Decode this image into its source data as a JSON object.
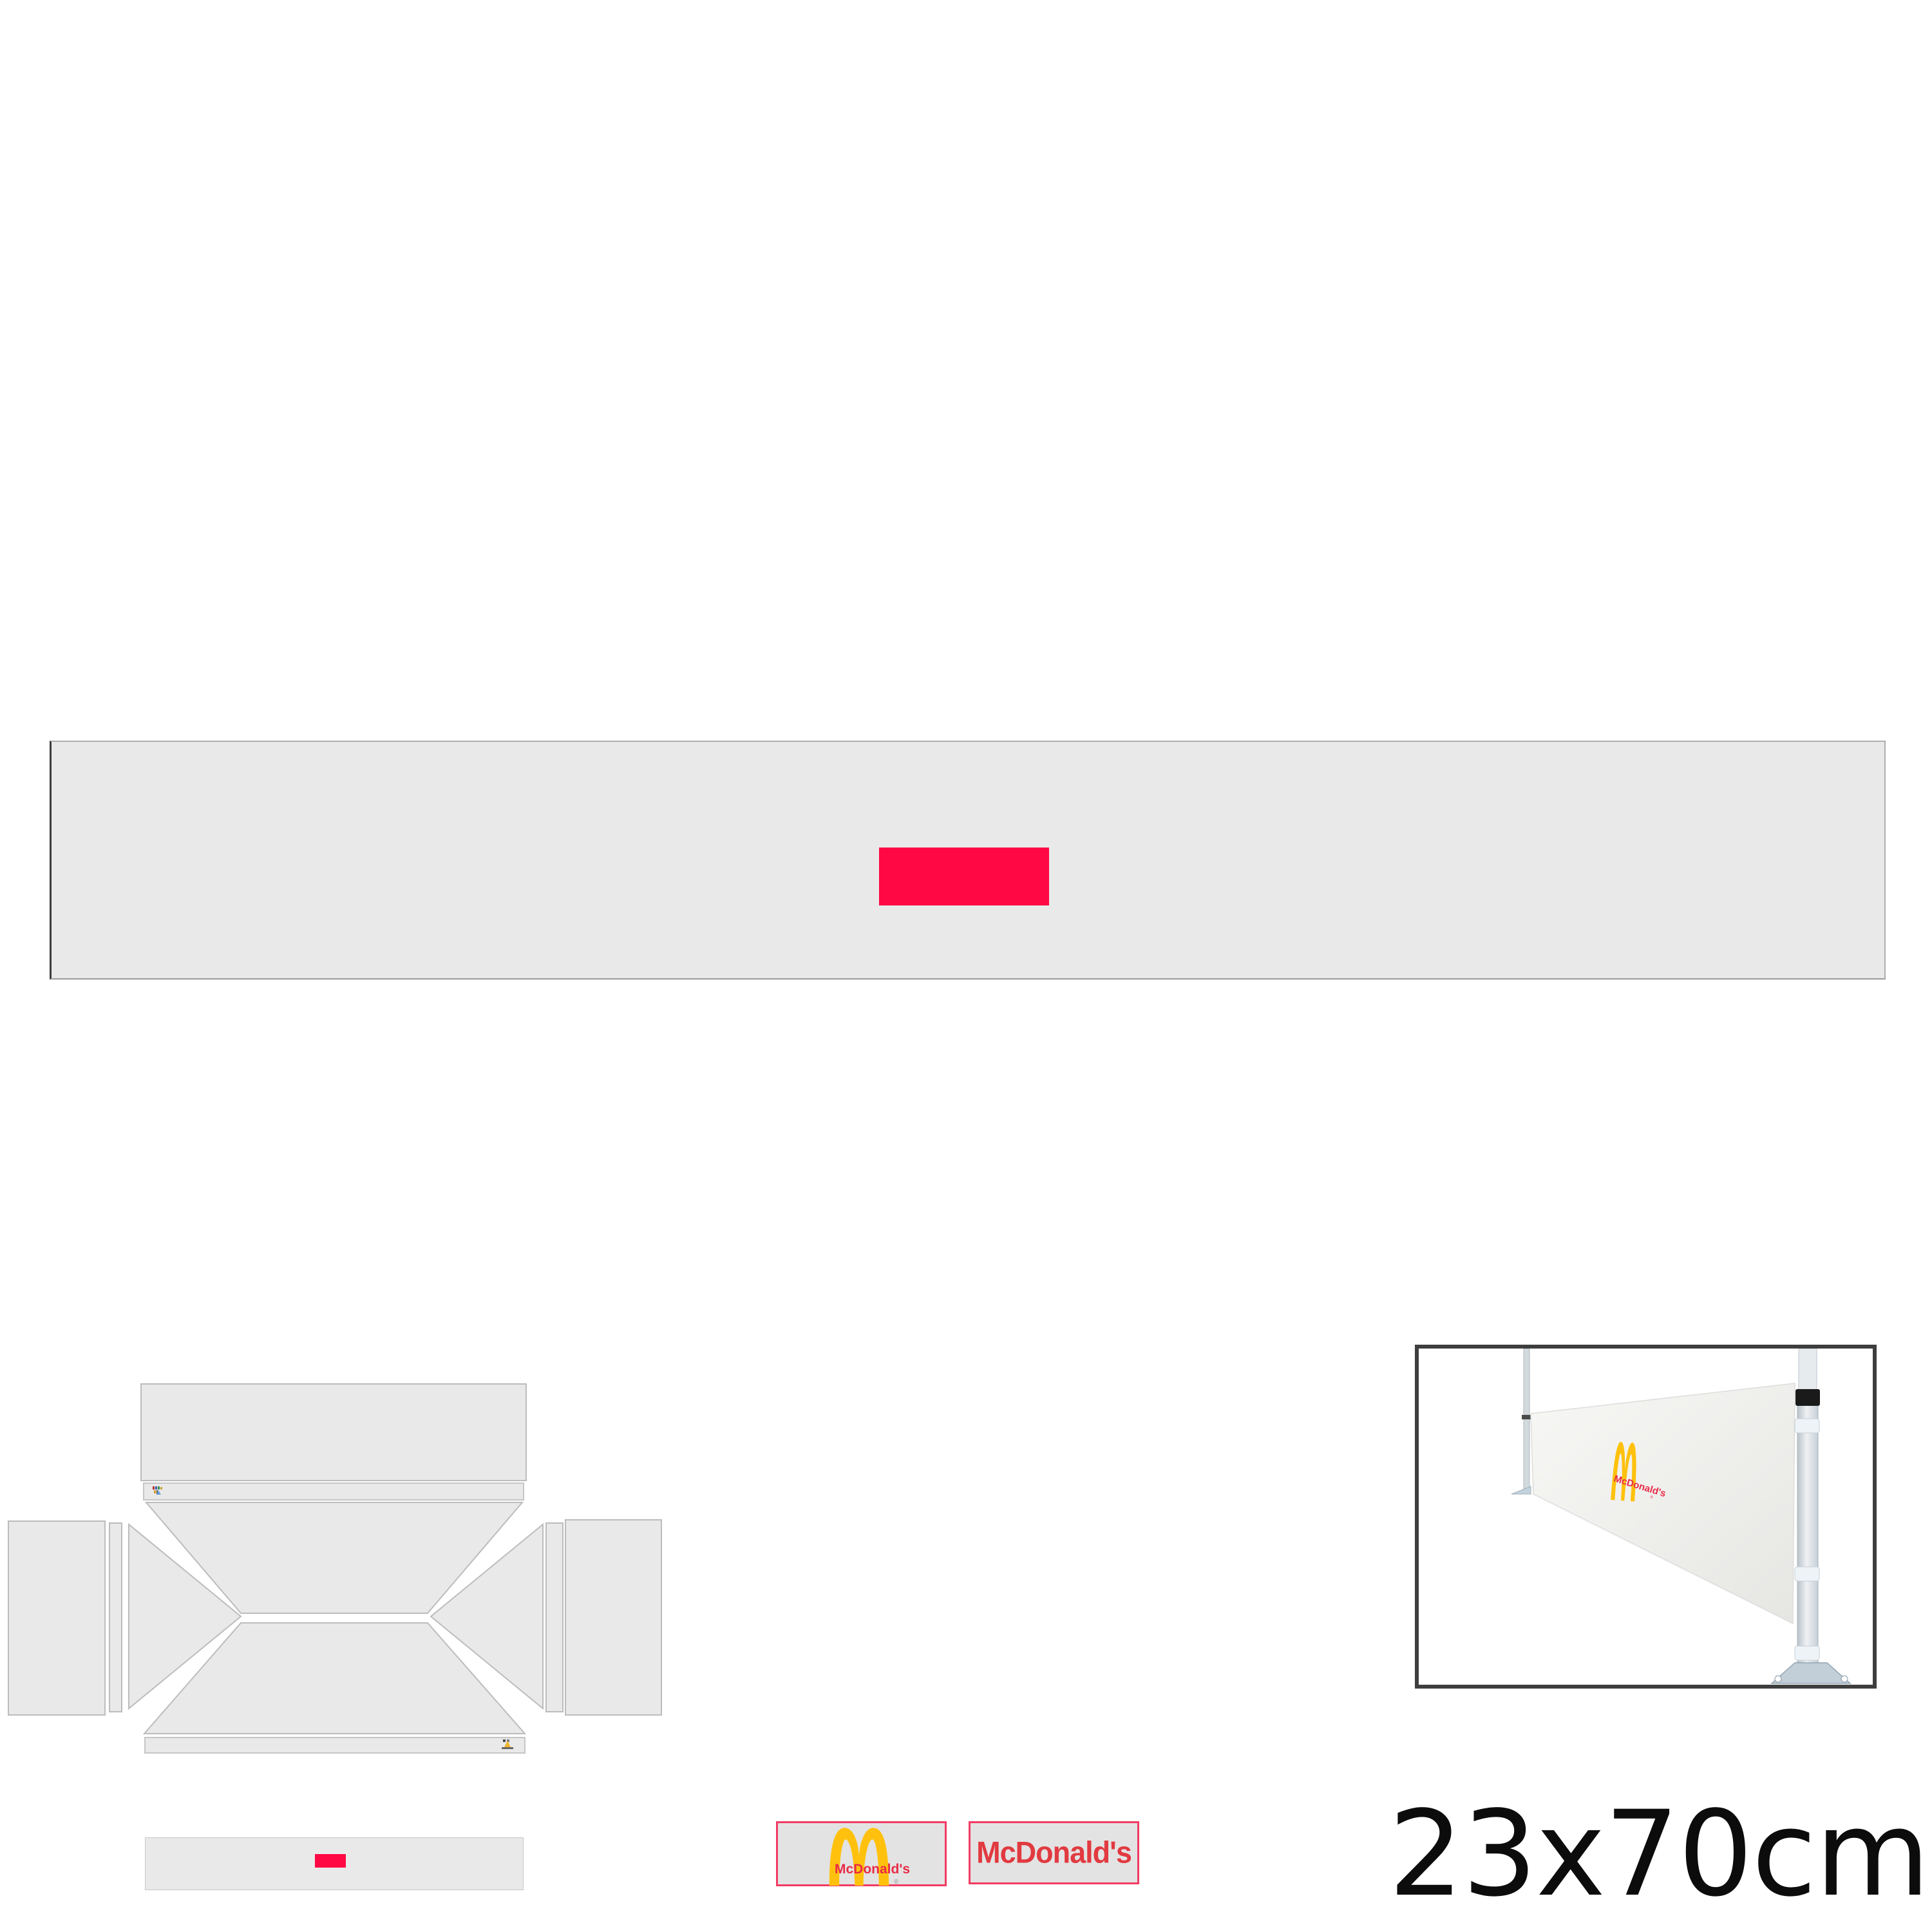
{
  "size_label": "23x70cm",
  "colors": {
    "pageBg": "#ffffff",
    "panelFill": "#e9e9e9",
    "panelStroke": "#bcbcbc",
    "bannerBorder": "#aeaeae",
    "bannerBorderDark": "#3c3c3c",
    "accentRed": "#ff0843",
    "swatchBorder": "#f23b63",
    "swatchBg": "#e3e3e3",
    "archesYellow": "#ffc10d",
    "mcdTextRed": "#e92a47",
    "wordmarkRed": "#e13a40",
    "photoFrame": "#3e3e3e",
    "sizeLabelColor": "#0c0c0c"
  },
  "swatches": {
    "arches": {
      "wordmark": "McDonald's",
      "registered": "®"
    },
    "wordmark": {
      "text": "McDonald's"
    }
  },
  "photo": {
    "banner_logo": {
      "text": "McDonald's",
      "registered": "®"
    }
  }
}
